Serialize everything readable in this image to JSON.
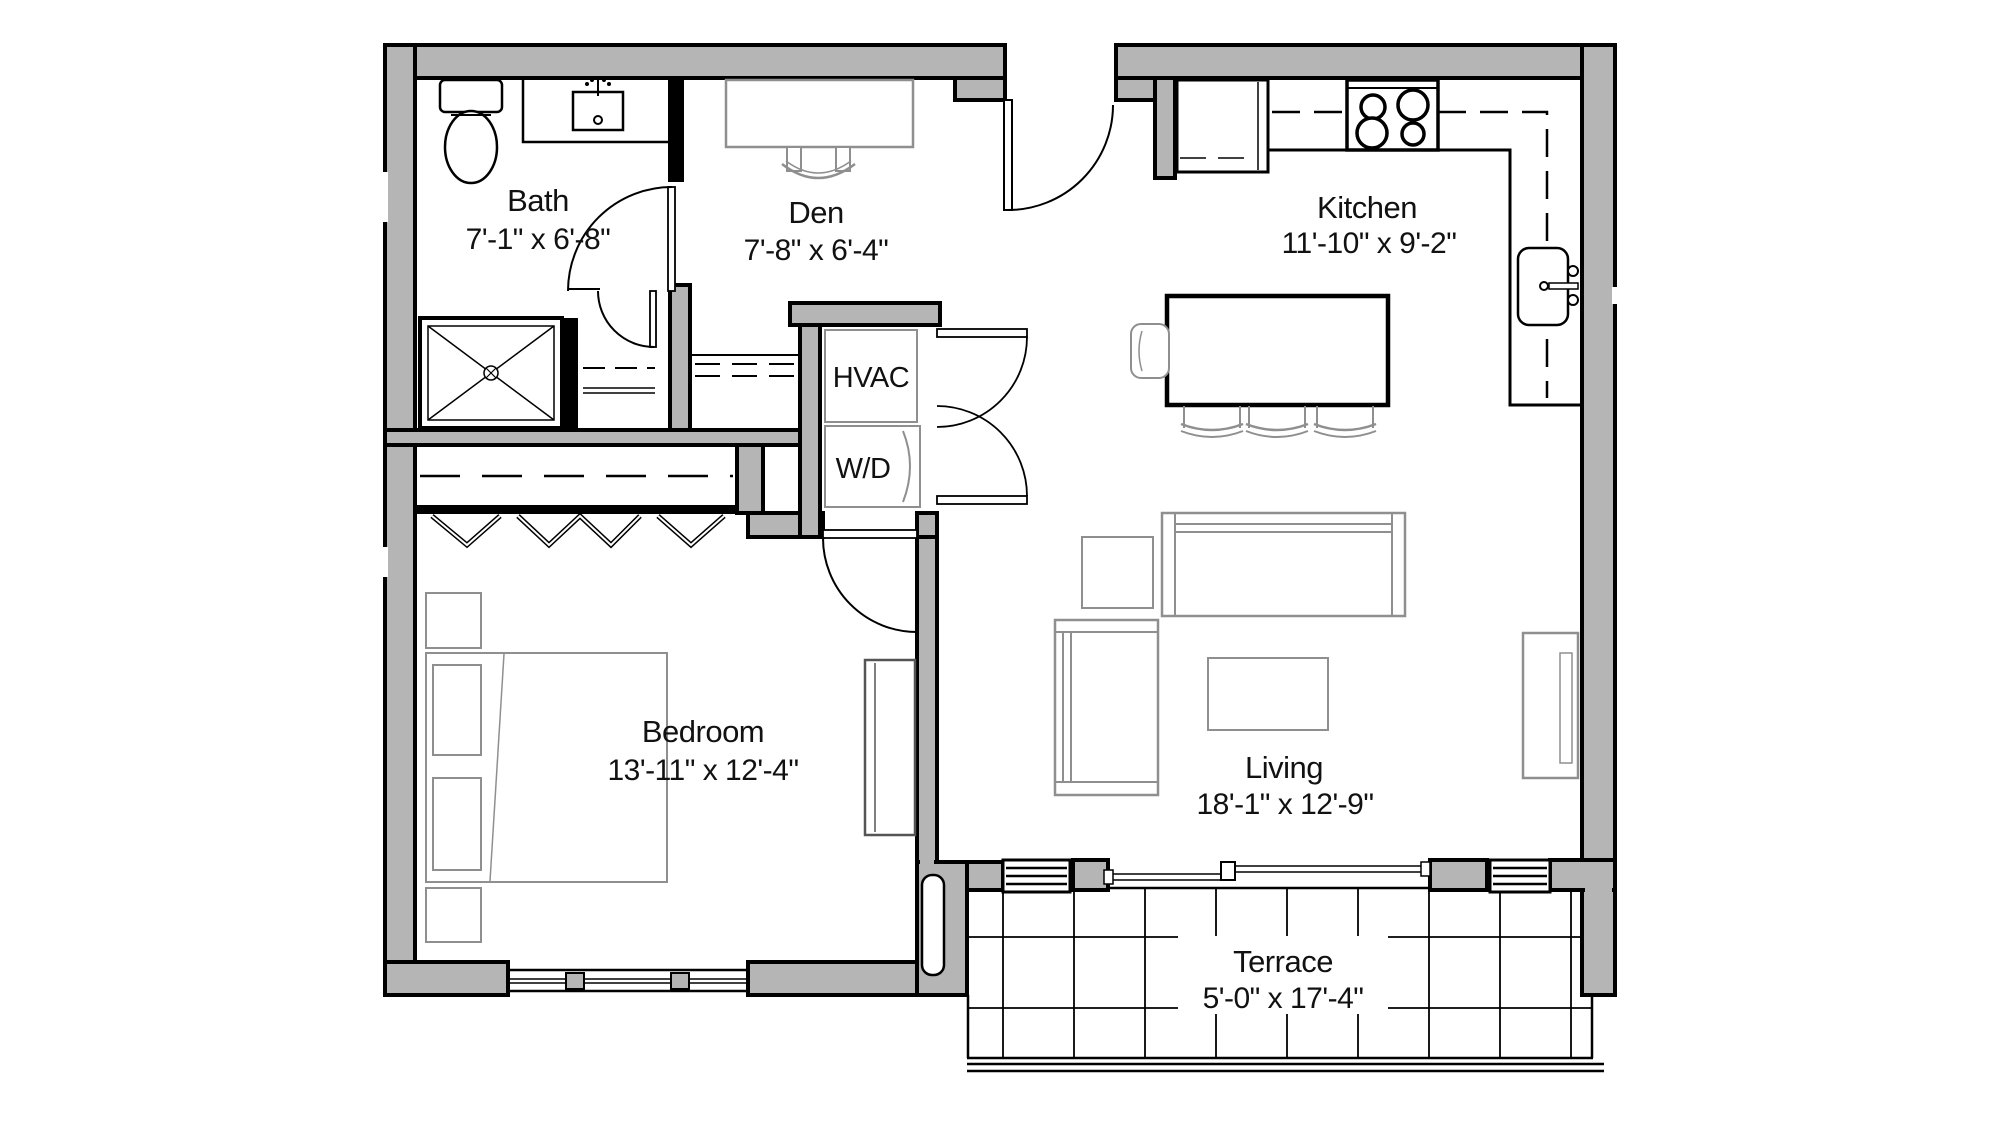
{
  "page": {
    "title": "Floor Plan",
    "background": "#ffffff"
  },
  "colors": {
    "wall_fill": "#b5b5b5",
    "wall_line": "#000000",
    "furniture_line": "#8f8f8f",
    "text": "#111111"
  },
  "rooms": {
    "bath": {
      "name": "Bath",
      "dims": "7'-1\" x 6'-8\""
    },
    "den": {
      "name": "Den",
      "dims": "7'-8\" x 6'-4\""
    },
    "kitchen": {
      "name": "Kitchen",
      "dims": "11'-10\" x 9'-2\""
    },
    "bedroom": {
      "name": "Bedroom",
      "dims": "13'-11\" x 12'-4\""
    },
    "living": {
      "name": "Living",
      "dims": "18'-1\" x 12'-9\""
    },
    "terrace": {
      "name": "Terrace",
      "dims": "5'-0\" x 17'-4\""
    }
  },
  "closets": {
    "hvac": {
      "label": "HVAC"
    },
    "wd": {
      "label": "W/D"
    }
  },
  "fixtures": [
    "toilet",
    "bathroom-sink",
    "shower",
    "linen-shelves",
    "refrigerator",
    "stove",
    "kitchen-sink",
    "kitchen-island",
    "bar-stools",
    "island-chair",
    "desk",
    "desk-chair",
    "washer-dryer",
    "closet-rod",
    "bifold-doors",
    "bed",
    "pillows",
    "nightstands",
    "dresser",
    "sofa",
    "armchair",
    "side-table",
    "coffee-table",
    "tv-console",
    "entry-door",
    "bath-door",
    "bedroom-door",
    "closet-double-doors",
    "sliding-door",
    "windows",
    "terrace-tiles"
  ]
}
